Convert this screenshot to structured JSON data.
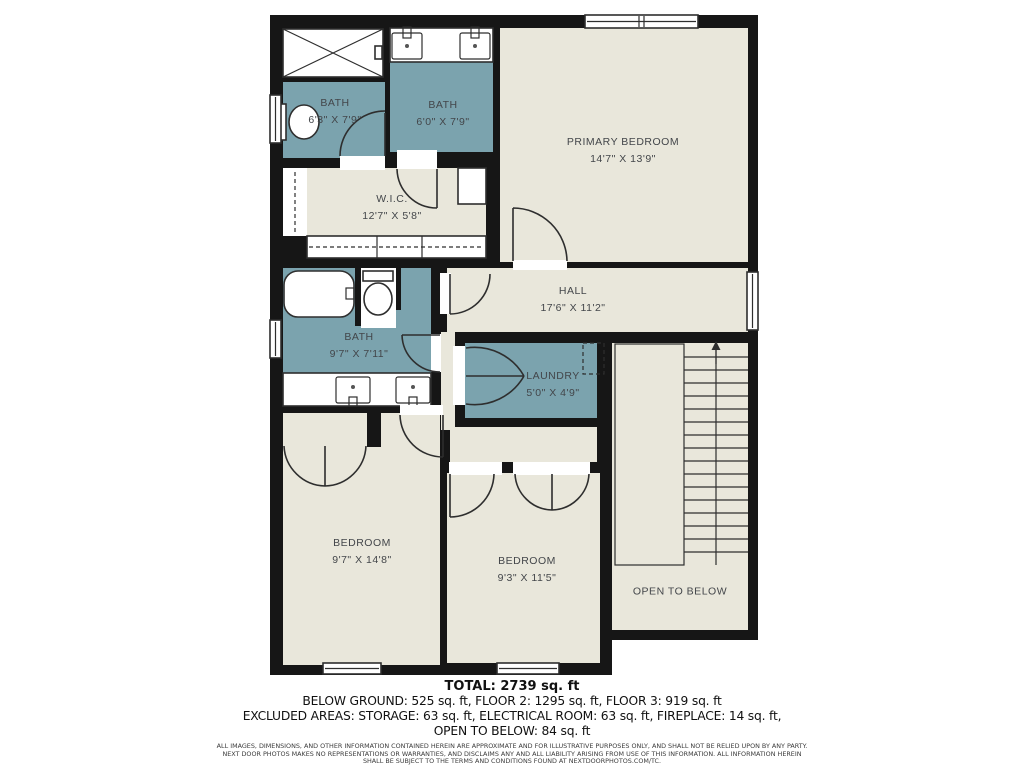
{
  "plan": {
    "rooms": [
      {
        "id": "bath1",
        "name": "BATH",
        "dims": "6'3\" X 7'9\""
      },
      {
        "id": "bath2",
        "name": "BATH",
        "dims": "6'0\" X 7'9\""
      },
      {
        "id": "primary_bedroom",
        "name": "PRIMARY BEDROOM",
        "dims": "14'7\" X 13'9\""
      },
      {
        "id": "wic",
        "name": "W.I.C.",
        "dims": "12'7\" X 5'8\""
      },
      {
        "id": "hall",
        "name": "HALL",
        "dims": "17'6\" X 11'2\""
      },
      {
        "id": "bath3",
        "name": "BATH",
        "dims": "9'7\" X 7'11\""
      },
      {
        "id": "laundry",
        "name": "LAUNDRY",
        "dims": "5'0\" X 4'9\""
      },
      {
        "id": "bedroom1",
        "name": "BEDROOM",
        "dims": "9'7\" X 14'8\""
      },
      {
        "id": "bedroom2",
        "name": "BEDROOM",
        "dims": "9'3\" X 11'5\""
      },
      {
        "id": "open_to_below",
        "name": "OPEN TO BELOW",
        "dims": ""
      }
    ],
    "colors": {
      "wall": "#161616",
      "room": "#e9e7db",
      "wet": "#7ba3ae",
      "line": "#2e2e2e",
      "label": "#43464a"
    }
  },
  "footer": {
    "total": "TOTAL: 2739 sq. ft",
    "floors": "BELOW GROUND: 525 sq. ft, FLOOR 2: 1295 sq. ft, FLOOR 3: 919 sq. ft",
    "excluded1": "EXCLUDED AREAS: STORAGE: 63 sq. ft, ELECTRICAL ROOM: 63 sq. ft, FIREPLACE: 14 sq. ft,",
    "excluded2": "OPEN TO BELOW: 84 sq. ft",
    "disclaimer1": "ALL IMAGES, DIMENSIONS, AND OTHER INFORMATION CONTAINED HEREIN ARE APPROXIMATE AND FOR ILLUSTRATIVE PURPOSES ONLY, AND SHALL NOT BE RELIED UPON BY ANY PARTY.",
    "disclaimer2": "NEXT DOOR PHOTOS MAKES NO REPRESENTATIONS OR WARRANTIES, AND DISCLAIMS ANY AND ALL LIABILITY ARISING FROM USE OF THIS INFORMATION. ALL INFORMATION HEREIN",
    "disclaimer3": "SHALL BE SUBJECT TO THE TERMS AND CONDITIONS FOUND AT NEXTDOORPHOTOS.COM/TC."
  }
}
